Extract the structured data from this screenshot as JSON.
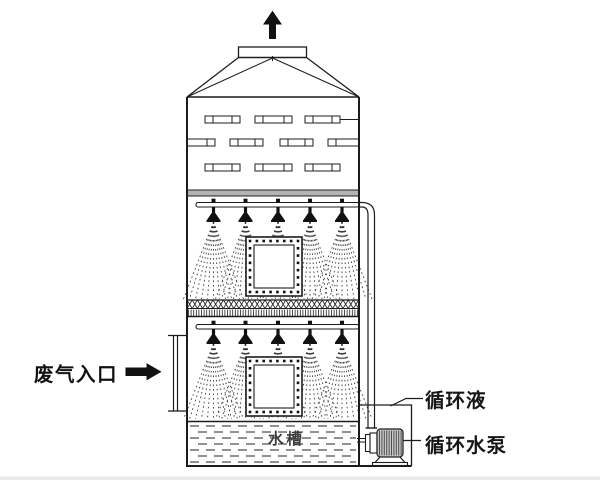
{
  "labels": {
    "waste_gas_inlet": "废气入口",
    "circulating_liquid": "循环液",
    "circulating_pump": "循环水泵",
    "water_tank": "水槽"
  },
  "colors": {
    "line": "#1c1c1c",
    "background": "#ffffff",
    "support_band": "#b3b3b3",
    "pump_body": "#c9c9c9",
    "pump_hatch": "#4d4d4d",
    "water_dash": "#3a3a3a",
    "spray_dot": "#222222",
    "bottom_strip": "#eaeaea"
  },
  "diagram": {
    "tower": {
      "left": 187,
      "right": 359,
      "top": 97,
      "bottom": 466
    },
    "slat_rows": [
      {
        "y": 116,
        "h": 7,
        "segments": [
          [
            205,
            240,
            "both"
          ],
          [
            255,
            292,
            "both"
          ],
          [
            305,
            340,
            "both"
          ]
        ],
        "tail": [
          340,
          359,
          119.5
        ]
      },
      {
        "y": 139,
        "h": 7,
        "segments": [
          [
            187,
            215,
            "right"
          ],
          [
            230,
            263,
            "both"
          ],
          [
            280,
            313,
            "both"
          ],
          [
            328,
            359,
            "left"
          ]
        ]
      },
      {
        "y": 164,
        "h": 7,
        "segments": [
          [
            205,
            240,
            "both"
          ],
          [
            255,
            292,
            "both"
          ],
          [
            305,
            340,
            "both"
          ]
        ]
      }
    ],
    "support_band": {
      "x": 187,
      "y": 190,
      "w": 172,
      "h": 6
    },
    "spray_sections": [
      {
        "pipe_y": 202.5,
        "pipe_h": 4.5,
        "pipe_x0": 196,
        "nozzle_x": [
          213.5,
          245.5,
          278,
          310,
          342
        ],
        "spray_top": 222,
        "spray_bottom": 299,
        "spread": 30,
        "manhole": [
          246,
          237,
          56,
          59
        ]
      },
      {
        "pipe_y": 324.5,
        "pipe_h": 4.5,
        "pipe_x0": 196,
        "nozzle_x": [
          213.5,
          245.5,
          278,
          310,
          342
        ],
        "spray_top": 344,
        "spray_bottom": 419,
        "spread": 30,
        "manhole": [
          246,
          357,
          56,
          59
        ]
      }
    ],
    "packing_band": {
      "x": 187,
      "w": 172,
      "top": 300,
      "mid": 308.5,
      "bottom": 316.5
    },
    "tank": {
      "water_top": 426,
      "water_bottom": 462,
      "x0": 190,
      "x1": 356
    },
    "pump": {
      "body": [
        377,
        429,
        26,
        28
      ]
    }
  }
}
